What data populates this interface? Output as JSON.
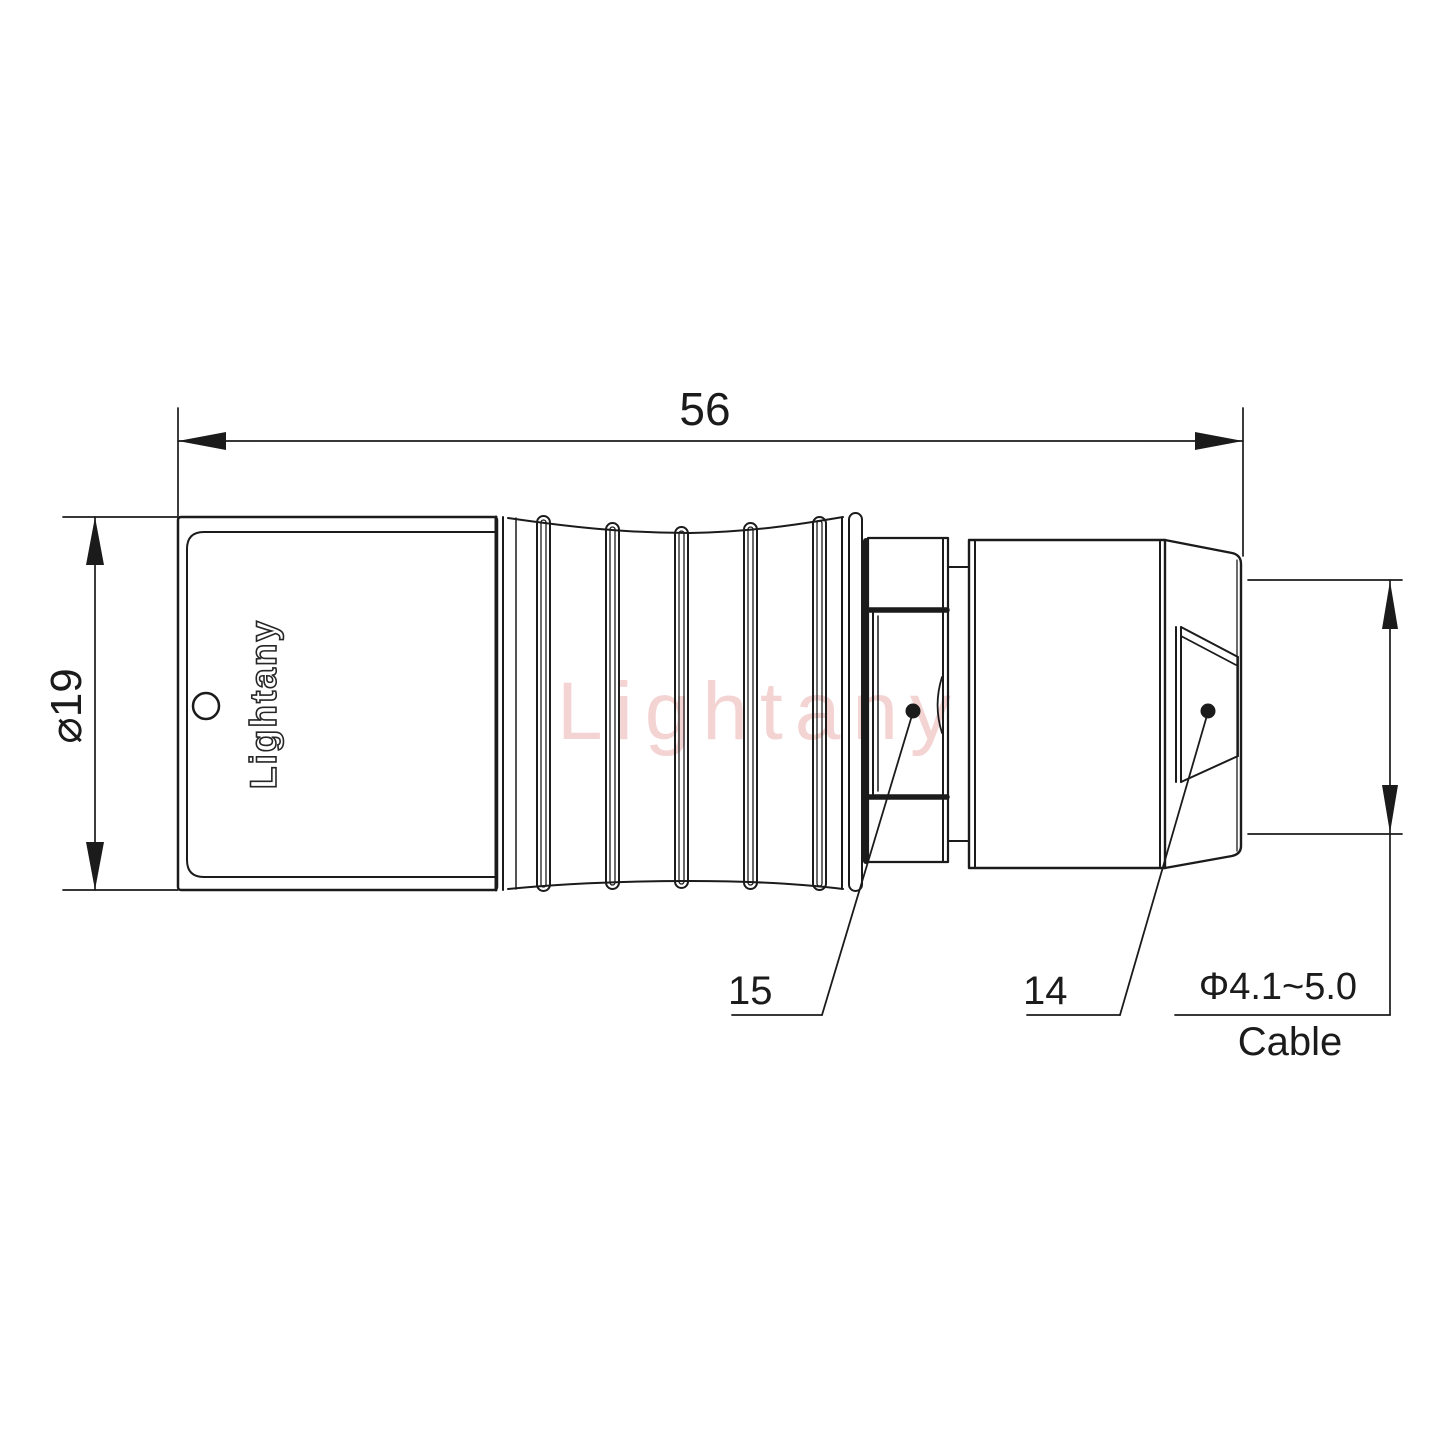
{
  "drawing": {
    "brand": {
      "logo": "Lightany",
      "watermark": "Lightany"
    },
    "dimensions": {
      "overall_length": "56",
      "shell_diameter": "⌀19",
      "cable_range": "Φ4.1~5.0",
      "cable_label": "Cable"
    },
    "part_numbers": {
      "inner_part": "15",
      "outer_part": "14"
    },
    "colors": {
      "line": "#1b1b1b",
      "watermark_pink": "#e79e9e"
    }
  }
}
